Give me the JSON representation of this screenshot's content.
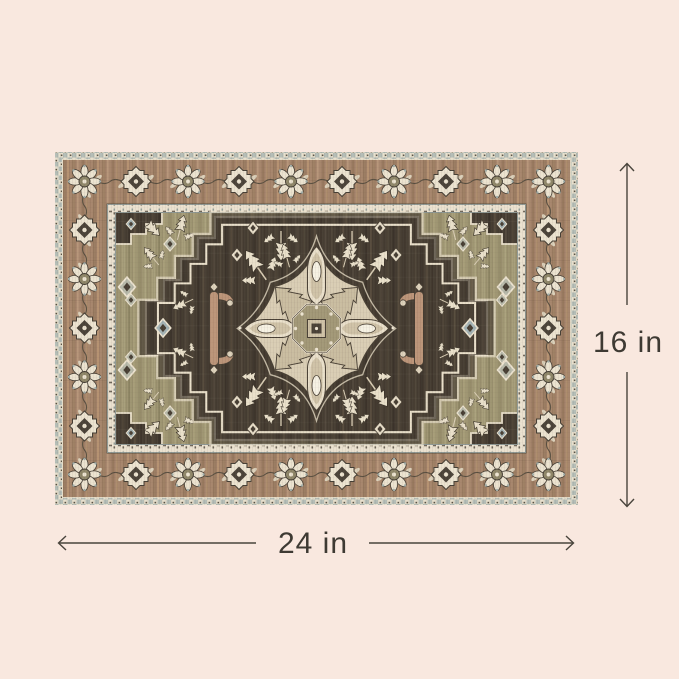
{
  "image": {
    "background_color": "#f9e8df"
  },
  "annotations": {
    "height": {
      "label": "16 in"
    },
    "width": {
      "label": "24 in"
    },
    "line_color": "#49443c",
    "label_color": "#3e3a33"
  },
  "rug": {
    "style": "heriz-medallion",
    "palette": {
      "border_brown": "#a5846a",
      "field_dark": "#453c31",
      "field_olive": "#9d9471",
      "motif_cream": "#ece3d0",
      "guard_cream": "#ebe2d0",
      "accent_bluegray": "#a4b4b6",
      "pendant_tan": "#bb9478",
      "outline_dark": "#473e33",
      "highlight_white": "#f6f1e3"
    }
  }
}
